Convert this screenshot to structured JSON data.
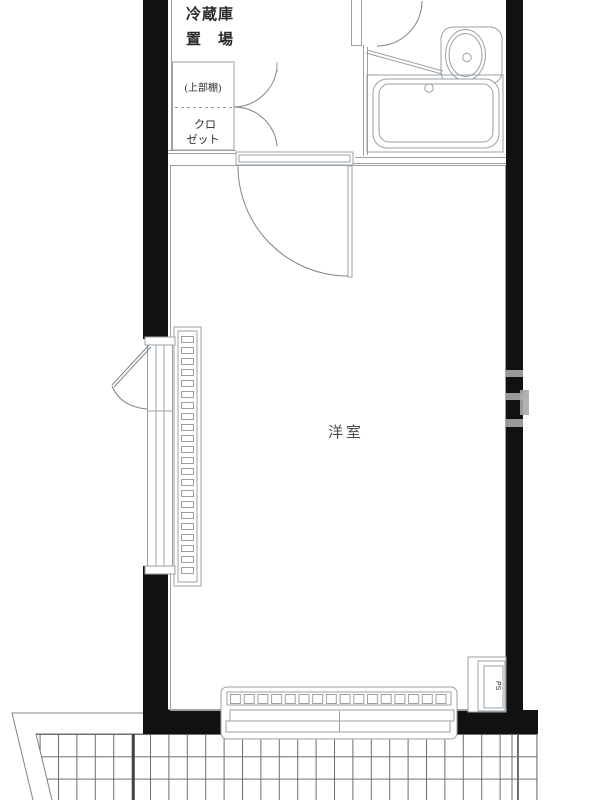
{
  "plan": {
    "labels": {
      "refrigerator_line1": "冷蔵庫",
      "refrigerator_line2": "置　場",
      "closet_shelf": "(上部棚)",
      "closet_line1": "クロ",
      "closet_line2": "ゼット",
      "main_room": "洋室",
      "pipe_space": "PS"
    },
    "colors": {
      "wall": "#111111",
      "line": "#9aa1a6",
      "line_dark": "#7d848a",
      "grid": "#6e6e6e",
      "text": "#2b2b2b",
      "text_soft": "#4a4a4a",
      "watermark": "#a9a9a9",
      "background": "#ffffff"
    }
  }
}
